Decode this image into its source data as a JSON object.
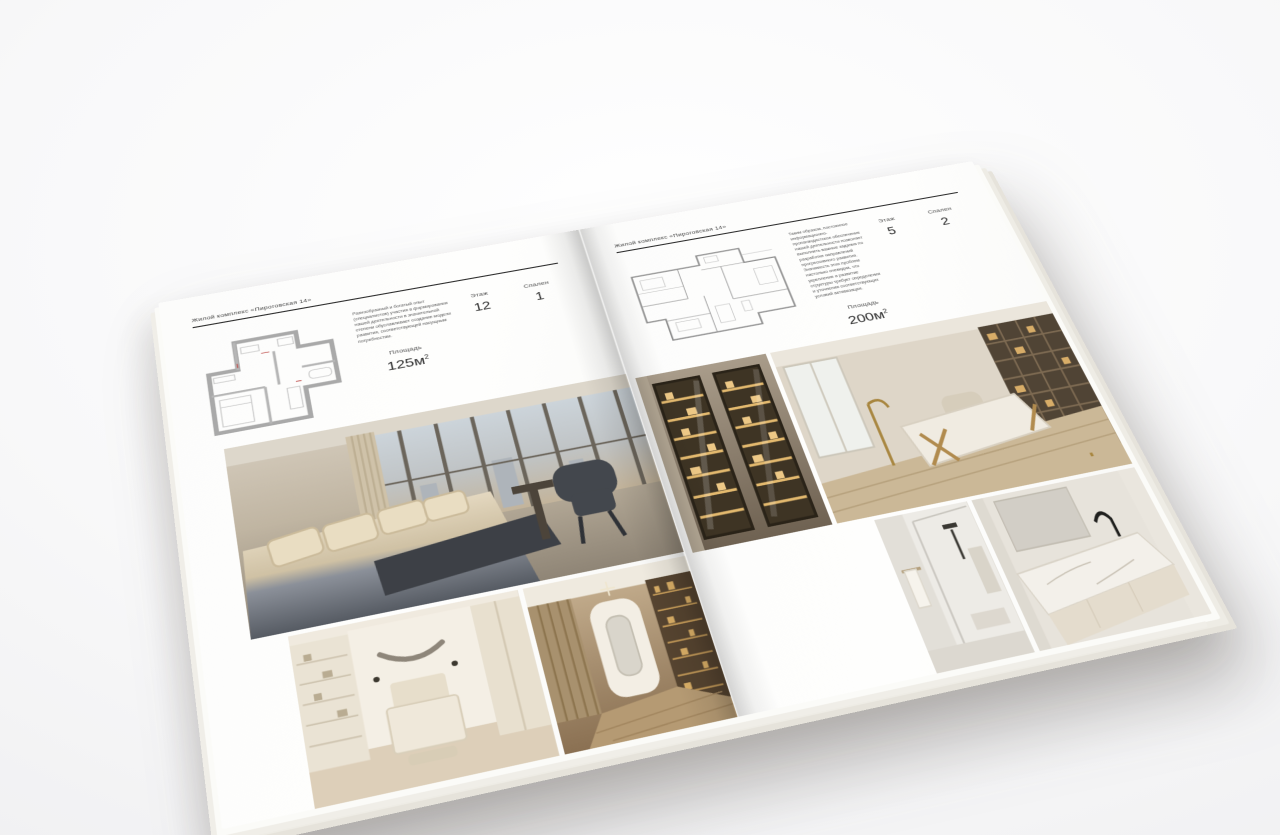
{
  "left_page": {
    "header": "Жилой комплекс «Пироговская 14»",
    "description": "Разнообразный и богатый опыт (специалистов) участия в формировании нашей деятельности в значительной степени обуславливает создание модели развития, соответствующей насущным потребностям.",
    "area_label": "Площадь",
    "area_value": "125м",
    "area_sup": "2",
    "floor_label": "Этаж",
    "floor_value": "12",
    "bedrooms_label": "Спален",
    "bedrooms_value": "1",
    "photos": {
      "main": "bedroom-panoramic-window",
      "bottom_left": "light-bedroom",
      "bottom_right": "hallway-bookshelves"
    }
  },
  "right_page": {
    "header": "Жилой комплекс «Пироговская 14»",
    "description": "Таким образом, постоянное информационно-пропагандистское обеспечение нашей деятельности позволяет выполнить важные задания по разработке направлений прогрессивного развития. Значимость этих проблем настолько очевидна, что укрепление и развитие структуры требует определения и уточнения соответствующих условий активизации.",
    "area_label": "Площадь",
    "area_value": "200м",
    "area_sup": "2",
    "floor_label": "Этаж",
    "floor_value": "5",
    "bedrooms_label": "Спален",
    "bedrooms_value": "2",
    "photos": {
      "mid_left": "glass-display-cabinets",
      "mid_right": "home-office-desk",
      "bottom_left": "shower-room",
      "bottom_right": "marble-vanity-bathroom"
    }
  },
  "colors": {
    "background": "#f4f4f5",
    "paper": "#fdfdfc",
    "ink": "#2e2e2e",
    "rule": "#2c2c2c",
    "plan_wall": "#a9a9a9",
    "plan_accent": "#c0504d",
    "photo_beige": "#cdbfa8",
    "photo_wood": "#9a7f5c",
    "photo_dark": "#3e4147",
    "photo_amber": "#d9ad64"
  }
}
